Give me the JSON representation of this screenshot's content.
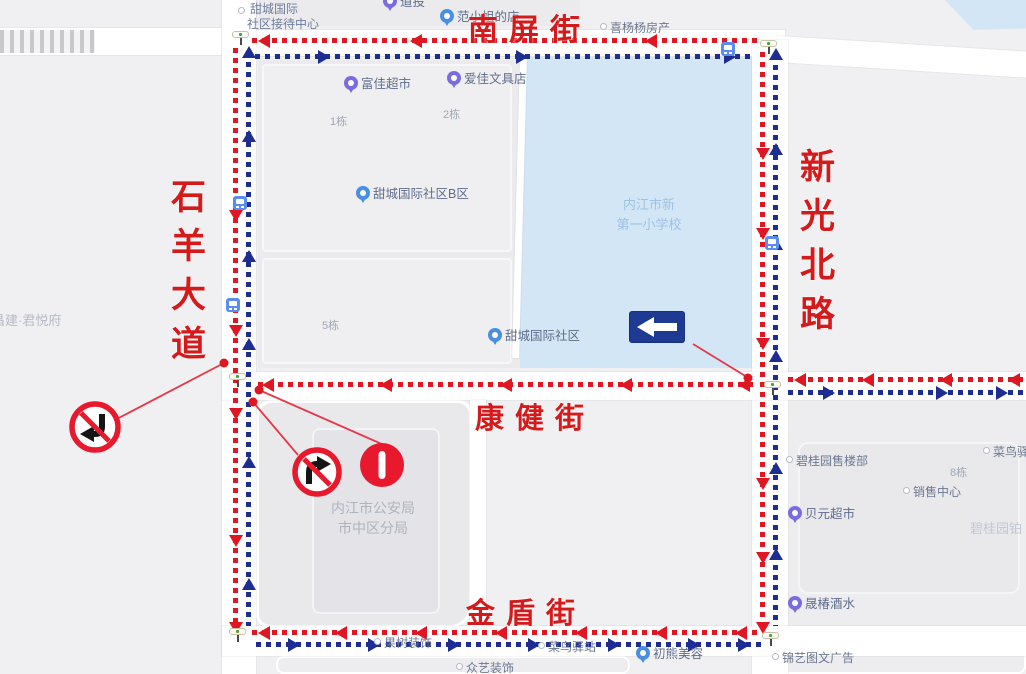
{
  "map": {
    "street_labels": {
      "nanping": "南屏街",
      "xinguang": "新光北路",
      "shiyang": "石羊大道",
      "kangjian": "康健街",
      "jindun": "金盾街"
    },
    "school_label": {
      "line1": "内江市新",
      "line2": "第一小学校"
    },
    "police_label": {
      "line1": "内江市公安局",
      "line2": "市中区分局"
    },
    "reception_label": {
      "line1": "甜城国际",
      "line2": "社区接待中心"
    },
    "colors": {
      "flow_red": "#e01622",
      "flow_blue": "#1e2d91",
      "label_red": "#d41a1a",
      "water": "#d3e6f6",
      "sign_blue": "#1e3a93",
      "leader_red": "#e5384a"
    },
    "signs": {
      "no_left_turn": "禁止左转标志",
      "no_right_turn": "禁止右转标志",
      "no_entry": "禁止驶入标志",
      "one_way_left": "单行道向左标志"
    },
    "pois": [
      {
        "label": "道投",
        "type": "pin-purple",
        "x": 383,
        "y": -6
      },
      {
        "label": "范小姐的店",
        "type": "pin-blue",
        "x": 440,
        "y": 9
      },
      {
        "label": "喜杨杨房产",
        "type": "dot",
        "x": 600,
        "y": 22
      },
      {
        "label": "富佳超市",
        "type": "pin-purple",
        "x": 344,
        "y": 76
      },
      {
        "label": "爱佳文具店",
        "type": "pin-purple",
        "x": 447,
        "y": 71
      },
      {
        "label": "1栋",
        "type": "plain-small",
        "x": 330,
        "y": 113
      },
      {
        "label": "2栋",
        "type": "plain-small",
        "x": 443,
        "y": 106
      },
      {
        "label": "甜城国际社区B区",
        "type": "pin-blue",
        "x": 356,
        "y": 186
      },
      {
        "label": "5栋",
        "type": "plain-small",
        "x": 322,
        "y": 317
      },
      {
        "label": "甜城国际社区",
        "type": "pin-blue",
        "x": 488,
        "y": 328
      },
      {
        "label": "昌建·君悦府",
        "type": "plain",
        "x": -8,
        "y": 310
      },
      {
        "label": "碧桂园售楼部",
        "type": "dot",
        "x": 786,
        "y": 455
      },
      {
        "label": "菜鸟驿站",
        "type": "dot",
        "x": 983,
        "y": 446
      },
      {
        "label": "8栋",
        "type": "plain-small",
        "x": 950,
        "y": 464
      },
      {
        "label": "销售中心",
        "type": "dot",
        "x": 903,
        "y": 486
      },
      {
        "label": "贝元超市",
        "type": "pin-purple",
        "x": 788,
        "y": 506
      },
      {
        "label": "碧桂园铂",
        "type": "plain-light",
        "x": 970,
        "y": 518
      },
      {
        "label": "晟椿酒水",
        "type": "pin-purple",
        "x": 788,
        "y": 596
      },
      {
        "label": "锦艺图文广告",
        "type": "dot",
        "x": 772,
        "y": 652
      },
      {
        "label": "果树装饰",
        "type": "dot",
        "x": 374,
        "y": 637
      },
      {
        "label": "众艺装饰",
        "type": "dot",
        "x": 456,
        "y": 662
      },
      {
        "label": "菜鸟驿站",
        "type": "dot",
        "x": 538,
        "y": 641
      },
      {
        "label": "初熊美容",
        "type": "pin-blue",
        "x": 636,
        "y": 646
      }
    ],
    "bus_stops": [
      {
        "x": 233,
        "y": 196
      },
      {
        "x": 226,
        "y": 298
      },
      {
        "x": 721,
        "y": 42
      },
      {
        "x": 765,
        "y": 236
      }
    ],
    "traffic_lights": [
      {
        "x": 232,
        "y": 31
      },
      {
        "x": 760,
        "y": 40
      },
      {
        "x": 229,
        "y": 373
      },
      {
        "x": 764,
        "y": 381
      },
      {
        "x": 229,
        "y": 628
      },
      {
        "x": 762,
        "y": 632
      }
    ],
    "flows": [
      {
        "o": "h",
        "x": 252,
        "y": 38,
        "len": 506,
        "color": "red",
        "arrows": [
          [
            258,
            "left"
          ],
          [
            410,
            "left"
          ],
          [
            645,
            "left"
          ]
        ]
      },
      {
        "o": "h",
        "x": 255,
        "y": 54,
        "len": 500,
        "color": "blue",
        "arrows": [
          [
            330,
            "right"
          ],
          [
            528,
            "right"
          ],
          [
            736,
            "right"
          ]
        ]
      },
      {
        "o": "v",
        "x": 233,
        "y": 48,
        "len": 582,
        "color": "red",
        "arrows": [
          [
            210,
            "down"
          ],
          [
            325,
            "down"
          ],
          [
            408,
            "down"
          ],
          [
            535,
            "down"
          ],
          [
            622,
            "down"
          ]
        ]
      },
      {
        "o": "v",
        "x": 246,
        "y": 52,
        "len": 574,
        "color": "blue",
        "arrows": [
          [
            58,
            "up"
          ],
          [
            142,
            "up"
          ],
          [
            262,
            "up"
          ],
          [
            350,
            "up"
          ],
          [
            468,
            "up"
          ],
          [
            590,
            "up"
          ]
        ]
      },
      {
        "o": "v",
        "x": 760,
        "y": 52,
        "len": 578,
        "color": "red",
        "arrows": [
          [
            148,
            "down"
          ],
          [
            228,
            "down"
          ],
          [
            338,
            "down"
          ],
          [
            478,
            "down"
          ],
          [
            552,
            "down"
          ],
          [
            622,
            "down"
          ]
        ]
      },
      {
        "o": "v",
        "x": 773,
        "y": 55,
        "len": 571,
        "color": "blue",
        "arrows": [
          [
            60,
            "up"
          ],
          [
            155,
            "up"
          ],
          [
            250,
            "up"
          ],
          [
            362,
            "up"
          ],
          [
            474,
            "up"
          ],
          [
            560,
            "up"
          ]
        ]
      },
      {
        "o": "h",
        "x": 258,
        "y": 382,
        "len": 497,
        "color": "red",
        "arrows": [
          [
            262,
            "left"
          ],
          [
            380,
            "left"
          ],
          [
            500,
            "left"
          ],
          [
            620,
            "left"
          ],
          [
            738,
            "left"
          ]
        ]
      },
      {
        "o": "h",
        "x": 788,
        "y": 377,
        "len": 238,
        "color": "red",
        "arrows": [
          [
            794,
            "left"
          ],
          [
            862,
            "left"
          ],
          [
            940,
            "left"
          ],
          [
            1008,
            "left"
          ]
        ]
      },
      {
        "o": "h",
        "x": 788,
        "y": 390,
        "len": 238,
        "color": "blue",
        "arrows": [
          [
            835,
            "right"
          ],
          [
            948,
            "right"
          ],
          [
            1008,
            "right"
          ]
        ]
      },
      {
        "o": "h",
        "x": 252,
        "y": 630,
        "len": 508,
        "color": "red",
        "arrows": [
          [
            258,
            "left"
          ],
          [
            335,
            "left"
          ],
          [
            415,
            "left"
          ],
          [
            495,
            "left"
          ],
          [
            575,
            "left"
          ],
          [
            655,
            "left"
          ],
          [
            735,
            "left"
          ]
        ]
      },
      {
        "o": "h",
        "x": 256,
        "y": 642,
        "len": 506,
        "color": "blue",
        "arrows": [
          [
            300,
            "right"
          ],
          [
            380,
            "right"
          ],
          [
            460,
            "right"
          ],
          [
            540,
            "right"
          ],
          [
            620,
            "right"
          ],
          [
            700,
            "right"
          ],
          [
            750,
            "right"
          ]
        ]
      }
    ],
    "annotation_dots": [
      {
        "x": 224,
        "y": 363
      },
      {
        "x": 259,
        "y": 390
      },
      {
        "x": 253,
        "y": 402
      },
      {
        "x": 748,
        "y": 378
      }
    ],
    "leader_lines": [
      {
        "x1": 224,
        "y1": 363,
        "x2": 113,
        "y2": 421
      },
      {
        "x1": 259,
        "y1": 390,
        "x2": 384,
        "y2": 445
      },
      {
        "x1": 253,
        "y1": 402,
        "x2": 298,
        "y2": 455
      },
      {
        "x1": 693,
        "y1": 344,
        "x2": 747,
        "y2": 377
      }
    ]
  }
}
